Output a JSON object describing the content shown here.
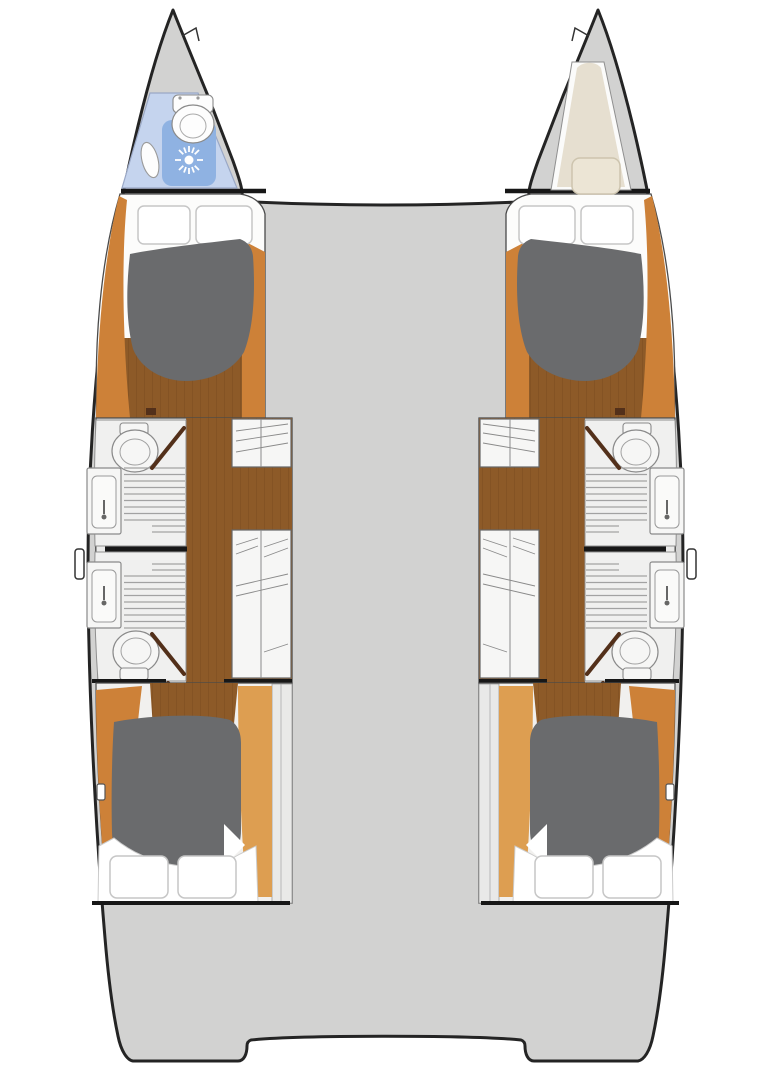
{
  "meta": {
    "description": "Top-down interior deck plan of a sailing catamaran with four double cabins and four bathrooms",
    "view": "catamaran-floor-plan"
  },
  "palette": {
    "background": "#ffffff",
    "deck": "#d2d2d1",
    "hullOutline": "#242424",
    "wall": "#4a4a4a",
    "wallLight": "#8f8f8f",
    "bulkhead": "#171717",
    "woodFloor": "#8d5a28",
    "plankLine": "#6b3f16",
    "trimDark": "#cd8138",
    "trimLight": "#dd9e51",
    "berthDark": "#6a6b6d",
    "linen": "#ffffff",
    "linenOutline": "#c6c6c6",
    "bathFloor": "#ebebea",
    "roomFloor": "#f0f0ef",
    "cabinBase": "#f1f0ee",
    "fixtureFill": "#f6f6f5",
    "fixtureOutline": "#8a8a8a",
    "grate": "#a2a2a2",
    "hatch": "#8a8a8a",
    "paleStrip": "#e9e9e8",
    "wetBlue": "#c5d4ee",
    "showerBlue": "#8fb2e2",
    "wetOutline": "#9aa8c6",
    "bowBerth": "#e6dfd0",
    "bowPillow": "#ece5d5",
    "bowPillowOutline": "#cdc4ae",
    "doorWood": "#53301a"
  },
  "vessel": {
    "type": "catamaran",
    "hull_count": 2,
    "port_hull_label": "Port hull: forepeak wet room (toilet, shower, sink), forward double cabin, two bathrooms with shower and sink, companionway steps, aft double cabin",
    "starboard_hull_label": "Starboard hull: forepeak berth with pillow, forward double cabin, two bathrooms with shower and sink, companionway steps, aft double cabin",
    "center_label": "Bridgedeck with forward trampoline gap and twin transom steps aft",
    "rooms": [
      {
        "hull": "port",
        "position": "bow",
        "name": "forepeak wet room",
        "fixtures": [
          "toilet",
          "shower with drain",
          "sink"
        ]
      },
      {
        "hull": "port",
        "position": "forward",
        "name": "double cabin",
        "fixtures": [
          "island berth",
          "two pillows",
          "wood floor",
          "wood trim"
        ]
      },
      {
        "hull": "port",
        "position": "midship-forward",
        "name": "bathroom",
        "fixtures": [
          "toilet",
          "shower grate",
          "sink with faucet",
          "door"
        ]
      },
      {
        "hull": "port",
        "position": "midship-aft",
        "name": "bathroom",
        "fixtures": [
          "sink with faucet",
          "shower grate",
          "toilet",
          "door"
        ]
      },
      {
        "hull": "port",
        "position": "midship-inboard",
        "name": "companionway steps and lockers"
      },
      {
        "hull": "port",
        "position": "aft",
        "name": "double cabin",
        "fixtures": [
          "island berth",
          "two pillows",
          "wood floor",
          "wood trim"
        ]
      },
      {
        "hull": "starboard",
        "position": "bow",
        "name": "forepeak berth",
        "fixtures": [
          "mattress",
          "pillow"
        ]
      },
      {
        "hull": "starboard",
        "position": "forward",
        "name": "double cabin",
        "fixtures": [
          "island berth",
          "two pillows",
          "wood floor",
          "wood trim"
        ]
      },
      {
        "hull": "starboard",
        "position": "midship-forward",
        "name": "bathroom",
        "fixtures": [
          "toilet",
          "shower grate",
          "sink with faucet",
          "door"
        ]
      },
      {
        "hull": "starboard",
        "position": "midship-aft",
        "name": "bathroom",
        "fixtures": [
          "sink with faucet",
          "shower grate",
          "toilet",
          "door"
        ]
      },
      {
        "hull": "starboard",
        "position": "midship-inboard",
        "name": "companionway steps and lockers"
      },
      {
        "hull": "starboard",
        "position": "aft",
        "name": "double cabin",
        "fixtures": [
          "island berth",
          "two pillows",
          "wood floor",
          "wood trim"
        ]
      }
    ]
  }
}
